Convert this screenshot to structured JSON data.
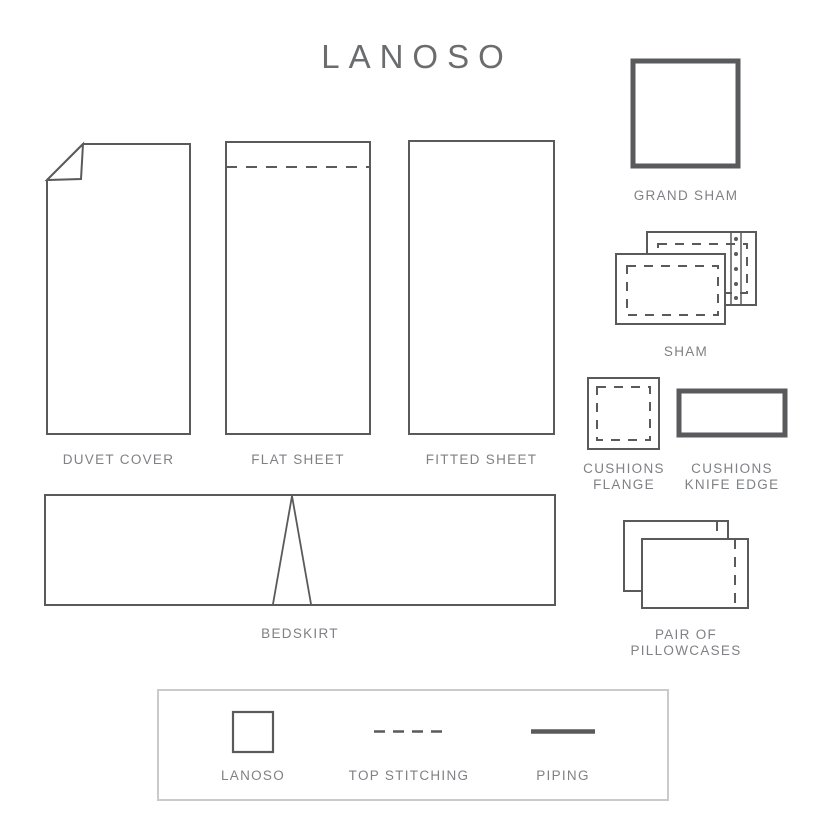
{
  "title": "LANOSO",
  "items": {
    "duvet_cover": {
      "label": "DUVET COVER"
    },
    "flat_sheet": {
      "label": "FLAT SHEET"
    },
    "fitted_sheet": {
      "label": "FITTED SHEET"
    },
    "bedskirt": {
      "label": "BEDSKIRT"
    },
    "grand_sham": {
      "label": "GRAND SHAM"
    },
    "sham": {
      "label": "SHAM"
    },
    "cushions_flange": {
      "label_line1": "CUSHIONS",
      "label_line2": "FLANGE"
    },
    "cushions_knife_edge": {
      "label_line1": "CUSHIONS",
      "label_line2": "KNIFE EDGE"
    },
    "pillowcases": {
      "label_line1": "PAIR OF",
      "label_line2": "PILLOWCASES"
    }
  },
  "legend": {
    "lanoso": {
      "label": "LANOSO"
    },
    "top_stitching": {
      "label": "TOP STITCHING"
    },
    "piping": {
      "label": "PIPING"
    }
  },
  "colors": {
    "outline": "#595a5c",
    "label_text": "#7f8184",
    "title_text": "#6a6c6e",
    "legend_border": "#c9cacb"
  }
}
